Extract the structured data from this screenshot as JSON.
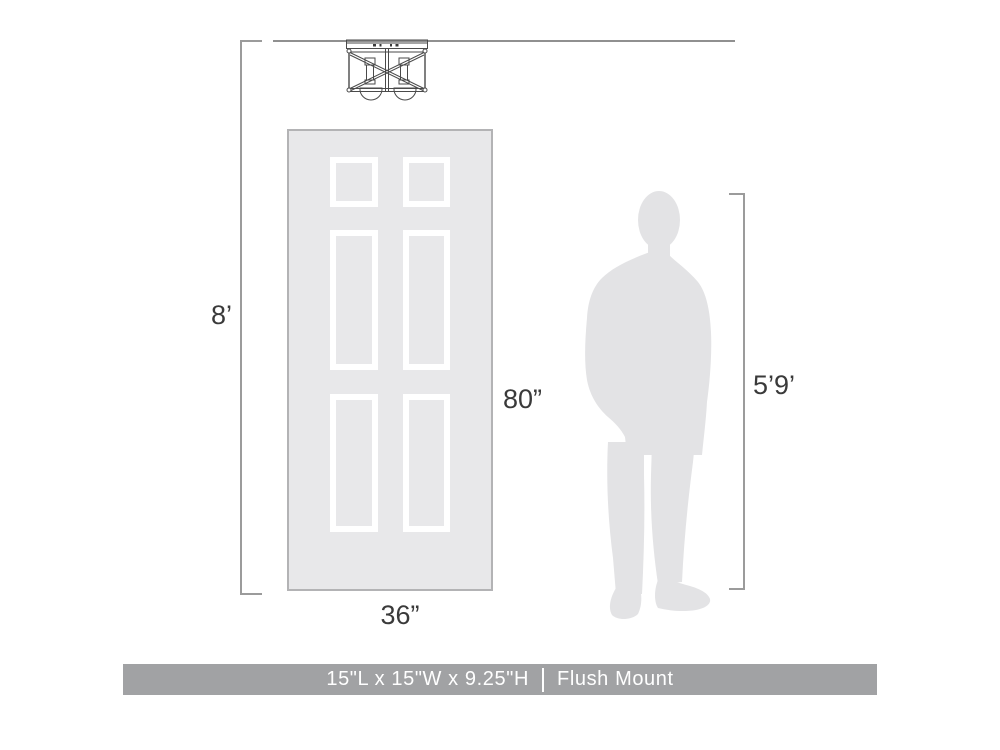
{
  "figure": {
    "type": "product-dimensions-diagram",
    "labels": {
      "ceiling_height": "8’",
      "door_height": "80”",
      "door_width": "36”",
      "person_height": "5’9’"
    },
    "caption": {
      "size": "15\"L x 15\"W x 9.25\"H",
      "mount": "Flush Mount"
    },
    "icons": {
      "fixture": "flush-mount-cage-light-icon",
      "door": "six-panel-door-figure",
      "person": "man-silhouette-figure"
    },
    "colors": {
      "door_fill": "#e8e8ea",
      "door_border": "#b3b3b5",
      "panel_frame": "#ffffff",
      "silhouette": "#e3e3e5",
      "dimension_line": "#9b9b9b",
      "ceiling_line": "#909090",
      "label_text": "#3a3a3a",
      "caption_bar": "#a1a2a4",
      "caption_text": "#ffffff",
      "fixture_line": "#4a4a4a"
    }
  }
}
